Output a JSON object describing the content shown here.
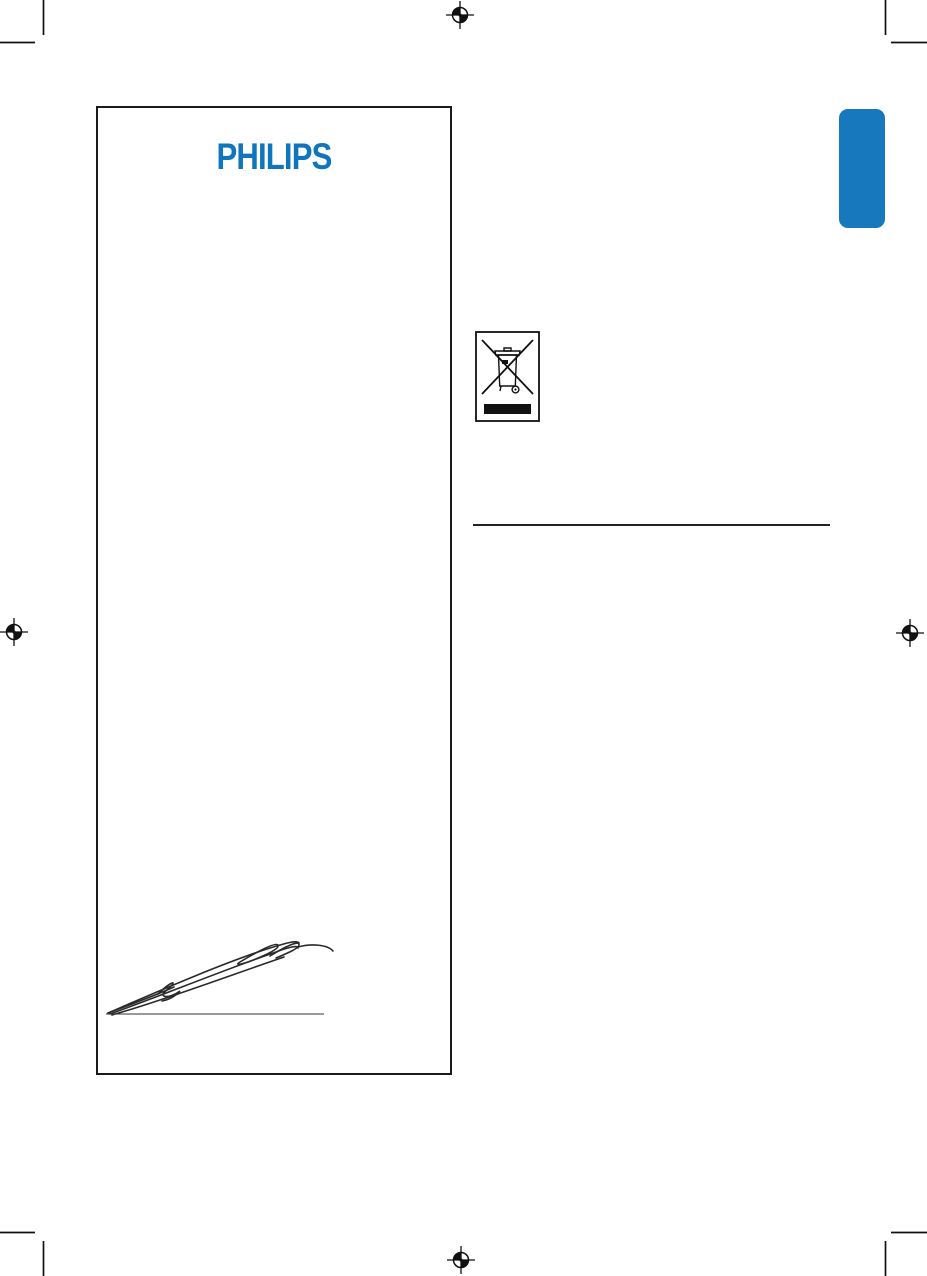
{
  "page": {
    "description": "Philips printed manual proof page with crop and registration marks",
    "background_color": "#ffffff"
  },
  "colors": {
    "philips_blue": "#0f75bc",
    "tab_blue": "#1878be",
    "ink_black": "#1a1a1a"
  },
  "logo": {
    "text": "PHILIPS"
  },
  "declaration_box": {
    "content": "signature-over-line"
  },
  "right_column": {
    "weee_icon": "crossed-out-wheelie-bin-icon",
    "divider": "horizontal-rule"
  },
  "print_marks": {
    "registration_marks": [
      "top-center",
      "left-middle",
      "right-middle",
      "bottom-center"
    ],
    "crop_marks": [
      "top-left",
      "top-right",
      "bottom-left",
      "bottom-right"
    ]
  }
}
